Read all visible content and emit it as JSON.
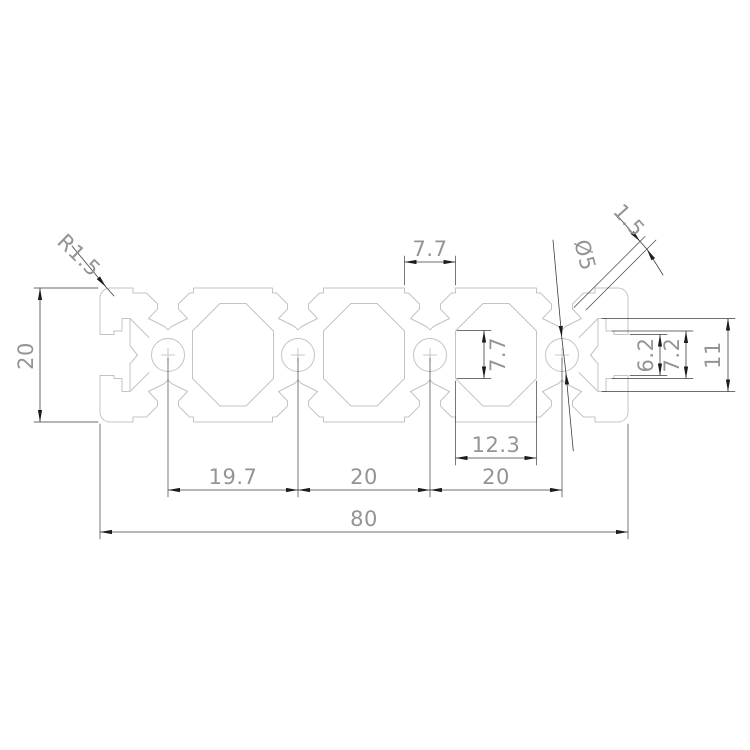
{
  "drawing": {
    "type": "technical-cad-dimension-drawing",
    "subject": "2080 aluminium extrusion profile cross-section",
    "units": "mm",
    "colors": {
      "background": "#ffffff",
      "profile_outline": "#c3c3c3",
      "dimension_lines": "#3f3f3f",
      "dimension_text": "#949494"
    },
    "dims": {
      "overall_width": "80",
      "overall_height": "20",
      "pitch_left": "19.7",
      "pitch_mid": "20",
      "pitch_right": "20",
      "cavity_width": "12.3",
      "slot_mouth_width": "7.7",
      "cavity_wall_height": "7.7",
      "hole_diameter": "Ø5",
      "corner_radius": "R1.5",
      "wall_thickness": "1.5",
      "end_slot_mouth": "6.2",
      "end_slot_inner": "7.2",
      "end_slot_outer": "11"
    }
  }
}
